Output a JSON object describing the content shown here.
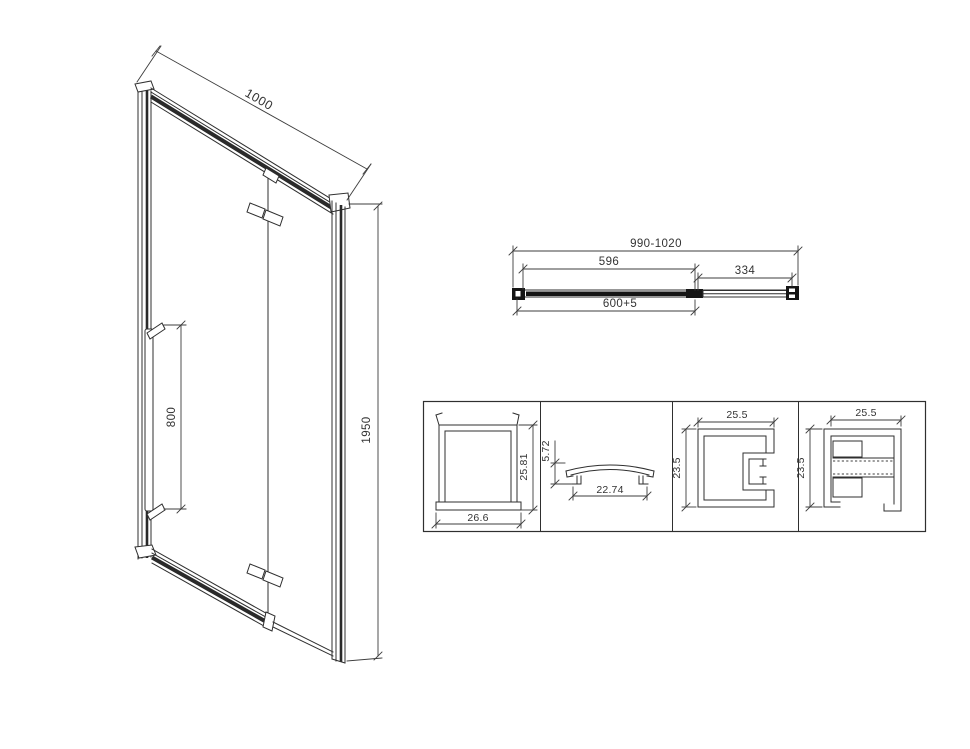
{
  "title": "Shower door technical drawing",
  "colors": {
    "background": "#ffffff",
    "line": "#2f2f2f",
    "dark_fill": "#151515",
    "text": "#333333"
  },
  "iso": {
    "dim_width": "1000",
    "dim_handle": "800",
    "dim_height": "1950"
  },
  "top_view": {
    "dim_overall": "990-1020",
    "dim_glass": "596",
    "dim_side": "334",
    "dim_door": "600+5"
  },
  "profiles": {
    "wall_channel": {
      "width": "26.6",
      "height": "25.81"
    },
    "cap": {
      "height": "5.72",
      "width": "22.74"
    },
    "c_profile": {
      "width": "25.5",
      "height": "23.5"
    },
    "e_profile": {
      "width": "25.5",
      "height": "23.5"
    }
  }
}
